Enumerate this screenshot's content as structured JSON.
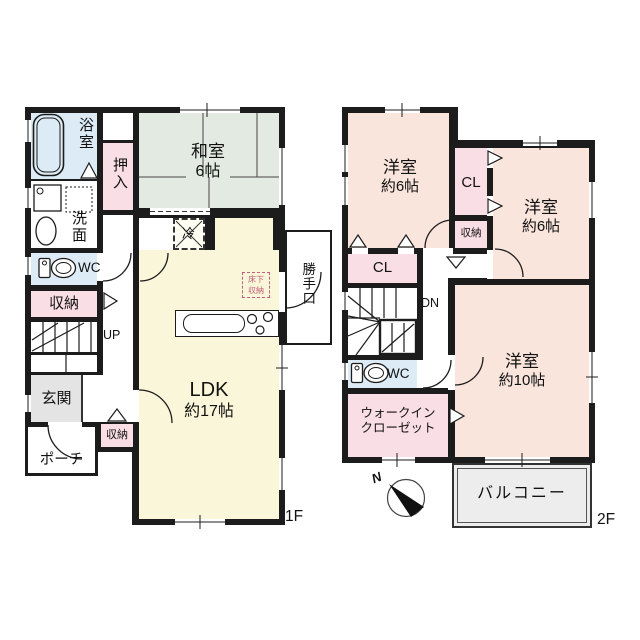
{
  "floor1": {
    "floor_label": "1F",
    "rooms": {
      "bath": "浴室",
      "washroom": "洗面",
      "oshiire_closet": "押入",
      "tatami_room_name": "和室",
      "tatami_room_size": "6帖",
      "toilet": "WC",
      "hall_storage": "収納",
      "stairs_up": "UP",
      "entrance": "玄関",
      "porch": "ポーチ",
      "entry_storage": "収納",
      "ldk_name": "LDK",
      "ldk_size": "約17帖",
      "refrigerator_space": "冷",
      "underfloor_storage_line1": "床下",
      "underfloor_storage_line2": "収納",
      "back_door": "勝手口"
    }
  },
  "floor2": {
    "floor_label": "2F",
    "rooms": {
      "bedroom_nw_name": "洋室",
      "bedroom_nw_size": "約6帖",
      "closet_center": "CL",
      "storage": "収納",
      "bedroom_ne_name": "洋室",
      "bedroom_ne_size": "約6帖",
      "closet_west": "CL",
      "stairs_down": "DN",
      "toilet": "WC",
      "walk_in_closet_line1": "ウォークイン",
      "walk_in_closet_line2": "クローゼット",
      "bedroom_south_name": "洋室",
      "bedroom_south_size": "約10帖",
      "balcony": "バルコニー"
    }
  },
  "compass": {
    "north_label": "N"
  },
  "colors": {
    "wall": "#1c1c1c",
    "tatami_room": "#e3eae1",
    "ldk": "#faf6d9",
    "western_room": "#f9e5dc",
    "closet_pink": "#fadee6",
    "wet_area_blue": "#dcebf5",
    "entrance_gray": "#e4e4e4",
    "balcony_gray": "#ededed",
    "underfloor_accent": "#c0607c"
  }
}
